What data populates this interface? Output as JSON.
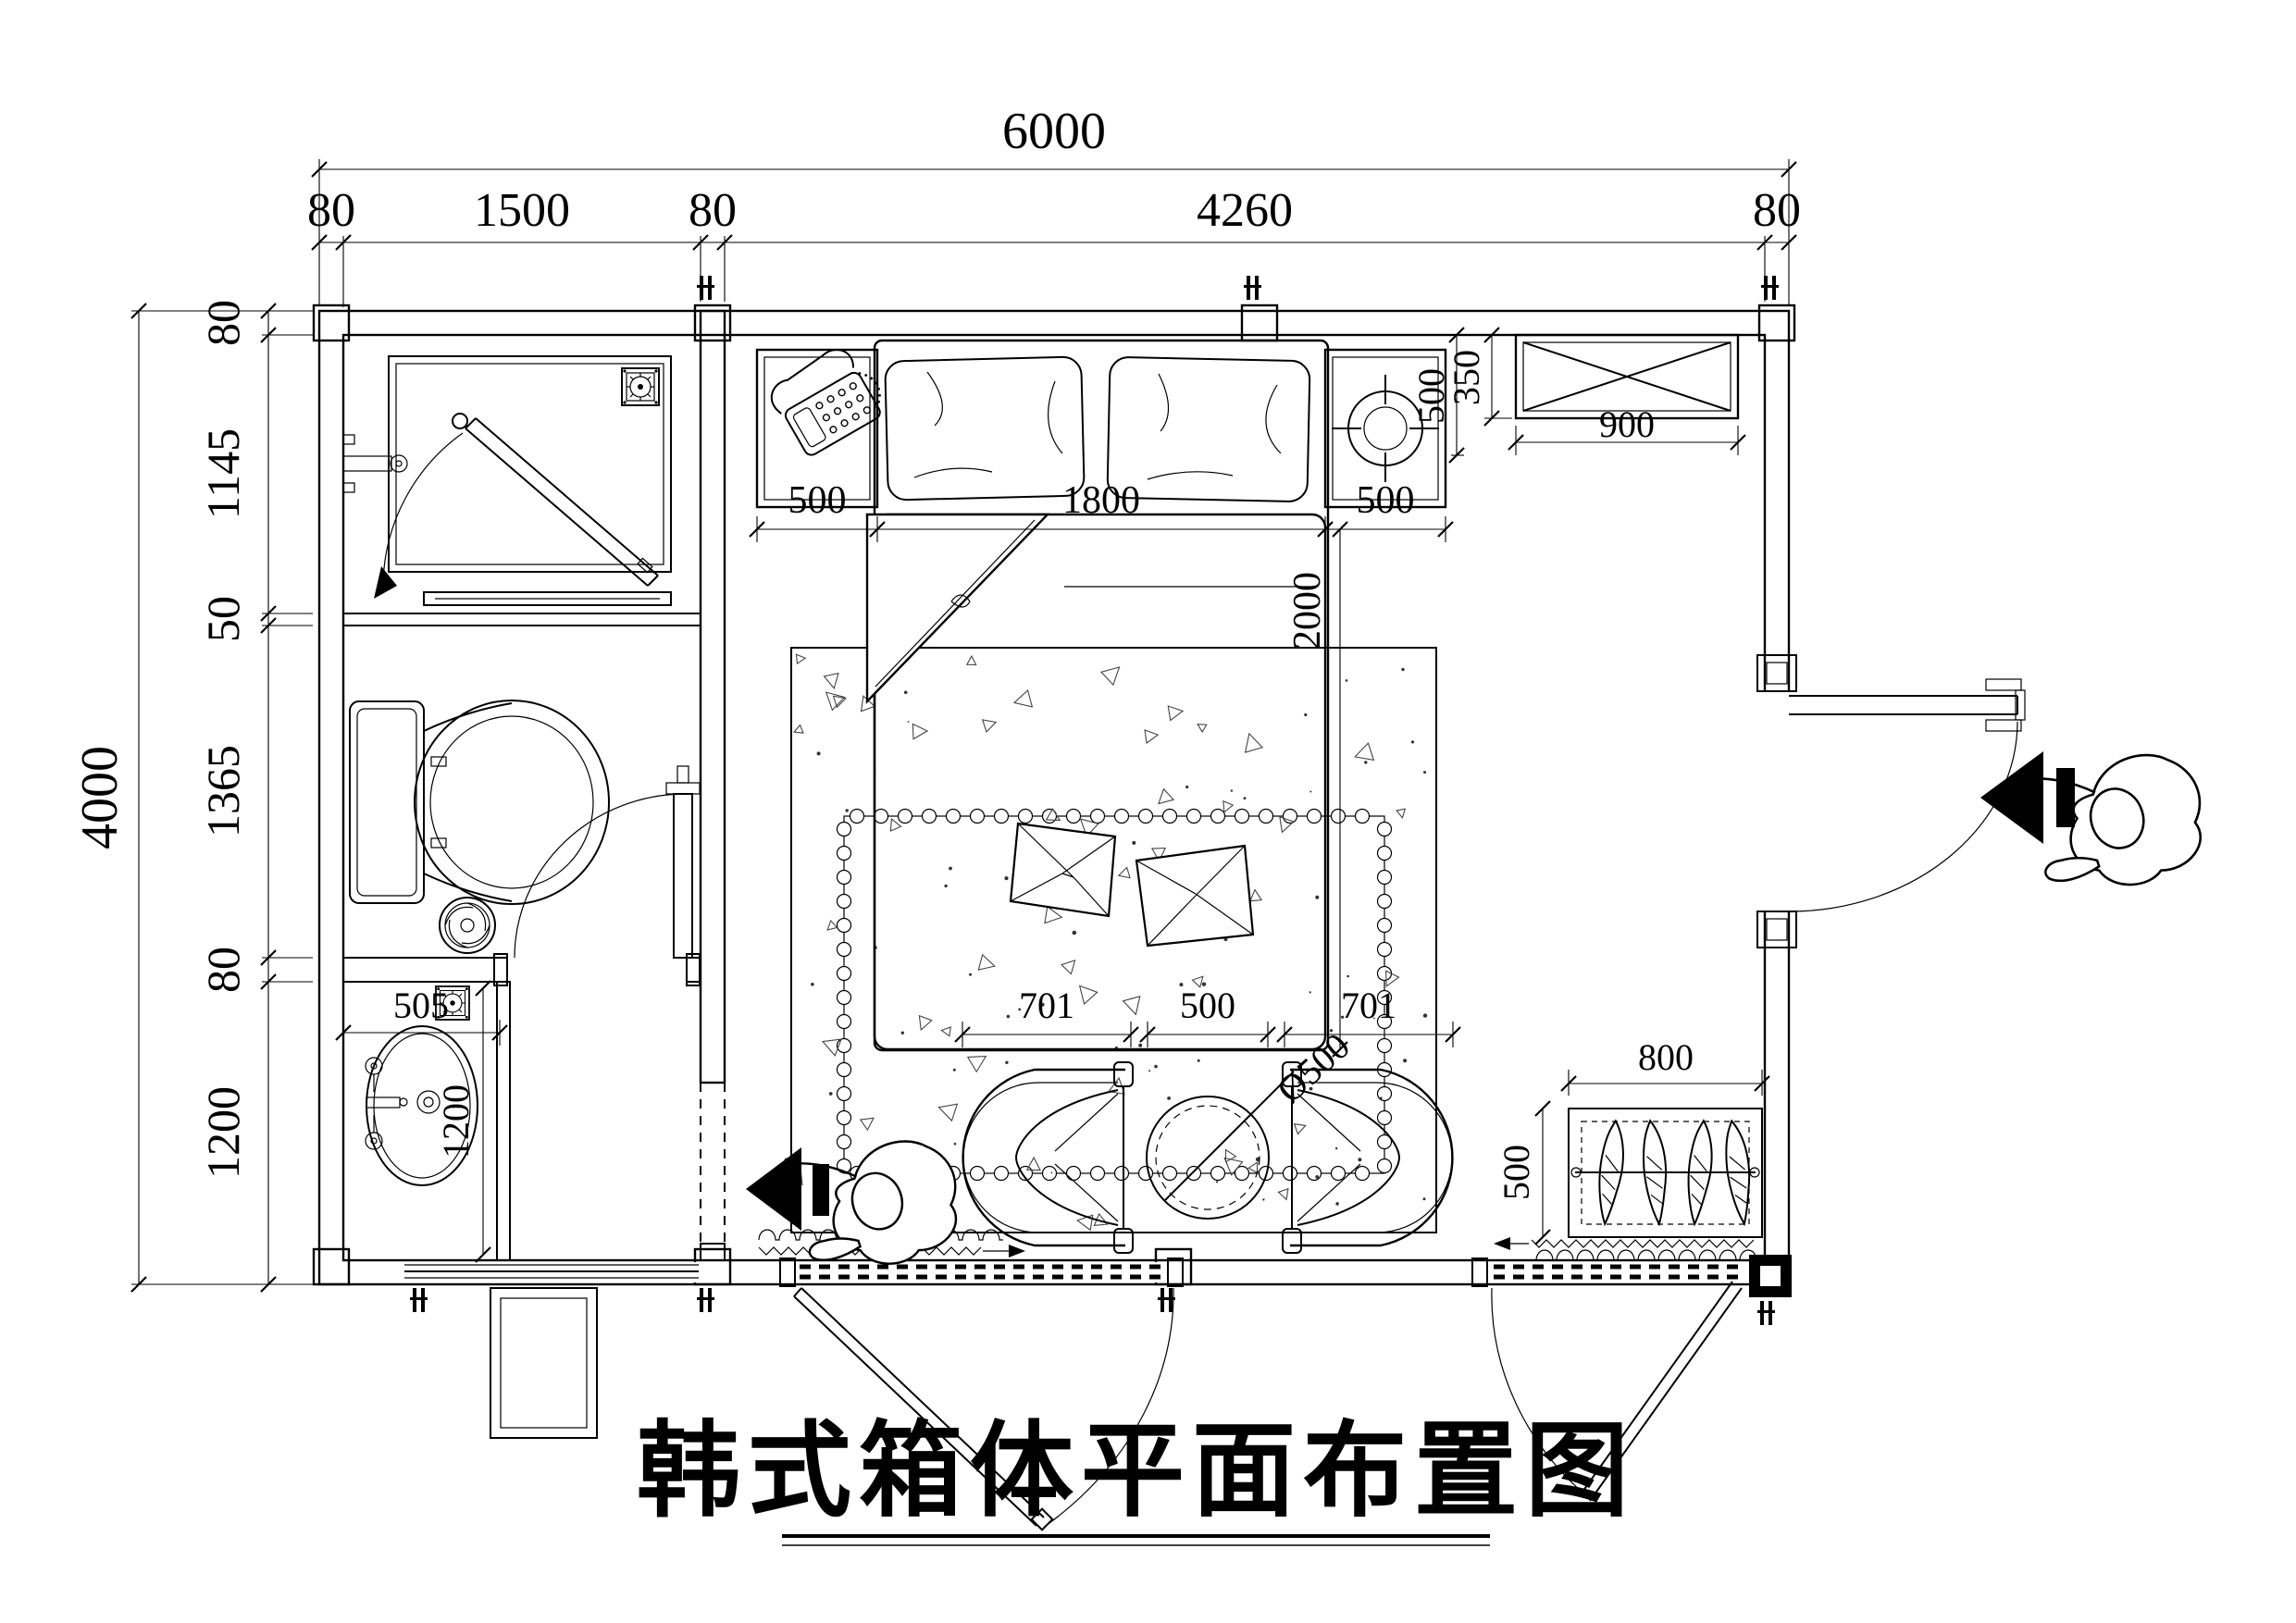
{
  "title": {
    "text": "韩式箱体平面布置图"
  },
  "colors": {
    "line": "#000000",
    "background": "#ffffff"
  },
  "dimensions": {
    "top": {
      "total": "6000",
      "segments": [
        "80",
        "1500",
        "80",
        "4260",
        "80"
      ]
    },
    "left": {
      "total": "4000",
      "segments": [
        "80",
        "1145",
        "50",
        "1365",
        "80",
        "1200"
      ]
    },
    "bed": {
      "left_clearance": "500",
      "width": "1800",
      "right_clearance": "500",
      "length": "2000"
    },
    "nightstand_depth": "500",
    "tv_cabinet": {
      "depth": "350",
      "width": "900"
    },
    "washbasin": {
      "width": "505",
      "counter_length": "1200"
    },
    "seating": {
      "left_chair": "701",
      "center_gap": "500",
      "right_chair": "701",
      "table_diameter": "Ø500"
    },
    "planter": {
      "width": "800",
      "depth": "500"
    }
  }
}
